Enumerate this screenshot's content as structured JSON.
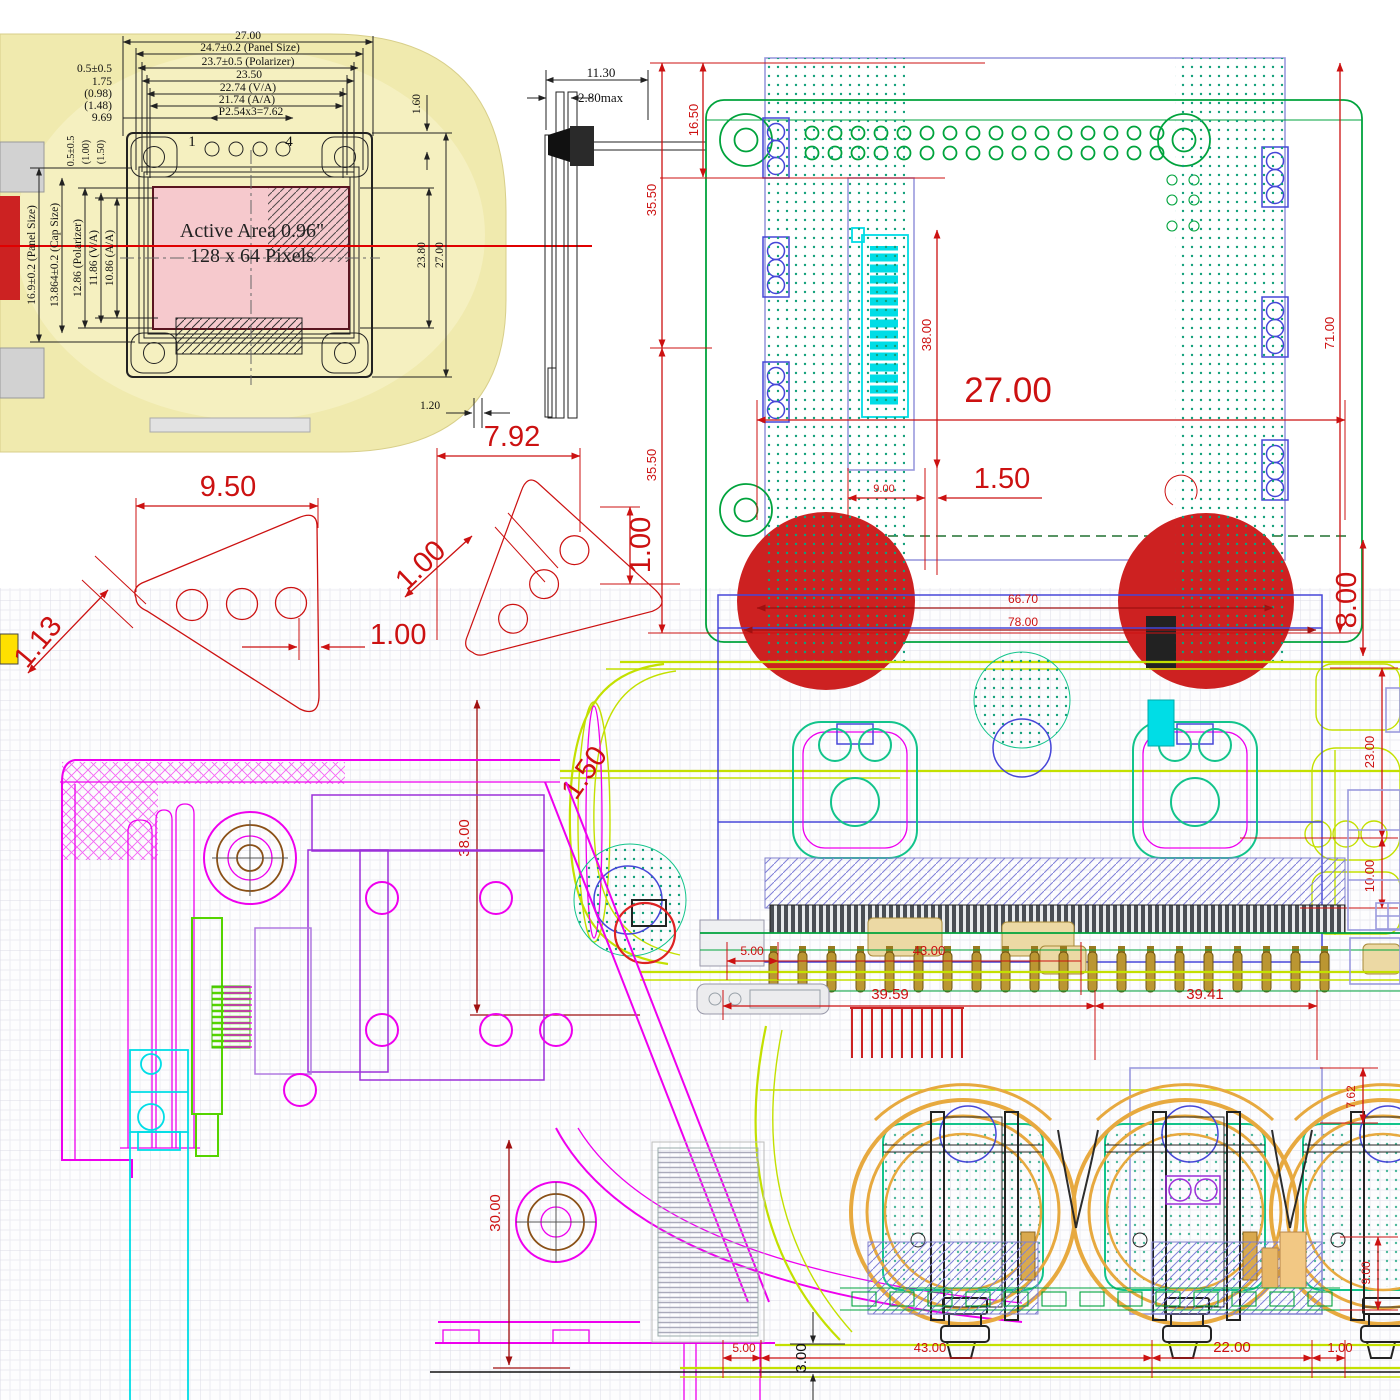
{
  "image_type": "engineering-cad-drawing-collage",
  "oled": {
    "active_area_line1": "Active Area 0.96\"",
    "active_area_line2": "128 x 64 Pixels",
    "pin_first": "1",
    "pin_last": "4",
    "top": {
      "overall": "27.00",
      "panel": "24.7±0.2 (Panel Size)",
      "polarizer": "23.7±0.5 (Polarizer)",
      "d2350": "23.50",
      "va": "22.74 (V/A)",
      "aa": "21.74 (A/A)",
      "pitch": "P2.54x3=7.62"
    },
    "top_left": {
      "a": "0.5±0.5",
      "b": "1.75",
      "c": "(0.98)",
      "d": "(1.48)",
      "e": "9.69"
    },
    "left": {
      "panel": "16.9±0.2 (Panel Size)",
      "cap": "13.864±0.2 (Cap Size)",
      "polarizer": "12.86 (Polarizer)",
      "va": "11.86 (V/A)",
      "aa": "10.86 (A/A)"
    },
    "left_top": {
      "a": "0.5±0.5",
      "b": "(1.00)",
      "c": "(1.50)"
    },
    "right": {
      "a": "23.80",
      "b": "27.00",
      "c": "1.60"
    },
    "side": {
      "a": "11.30",
      "b": "2.80max",
      "c": "1.20"
    }
  },
  "pcb": {
    "d1650": "16.50",
    "d3550u": "35.50",
    "d3550l": "35.50",
    "d3800": "38.00",
    "d2700": "27.00",
    "d150": "1.50",
    "d900": "9.00",
    "d7100": "71.00",
    "d800": "8.00"
  },
  "bracket": {
    "d950": "9.50",
    "d113": "1.13",
    "d100": "1.00",
    "d792": "7.92",
    "d100d": "1.00",
    "d100v": "1.00"
  },
  "assembly": {
    "d6670": "66.70",
    "d7800": "78.00",
    "d2300": "23.00",
    "d1000": "10.00",
    "d150": "1.50",
    "d3800": "38.00",
    "d500": "5.00",
    "d4300": "43.00",
    "d3959": "39.59",
    "d3941": "39.41"
  },
  "chassis": {
    "d3000": "30.00",
    "d762": "7.62",
    "d900": "9.00",
    "d500": "5.00",
    "d4300": "43.00",
    "d300": "3.00",
    "d2200": "22.00",
    "d100": "1.00"
  },
  "colors": {
    "dim_red": "#cc1111",
    "dark_red": "#a01010",
    "magenta": "#ee00ee",
    "violet": "#9b30d9",
    "green": "#00a33c",
    "bright_green": "#55d400",
    "chartreuse": "#c3e000",
    "teal": "#12c48b",
    "cyan": "#00dde6",
    "blue": "#4646d8",
    "lavender": "#9a9ade",
    "amber": "#e7a93f",
    "gold": "#bb9632",
    "tan": "#ecd9a4",
    "pink_fill": "#f6c9cd",
    "device_yellow": "#f0eaae",
    "red_fill": "#cd2121"
  }
}
